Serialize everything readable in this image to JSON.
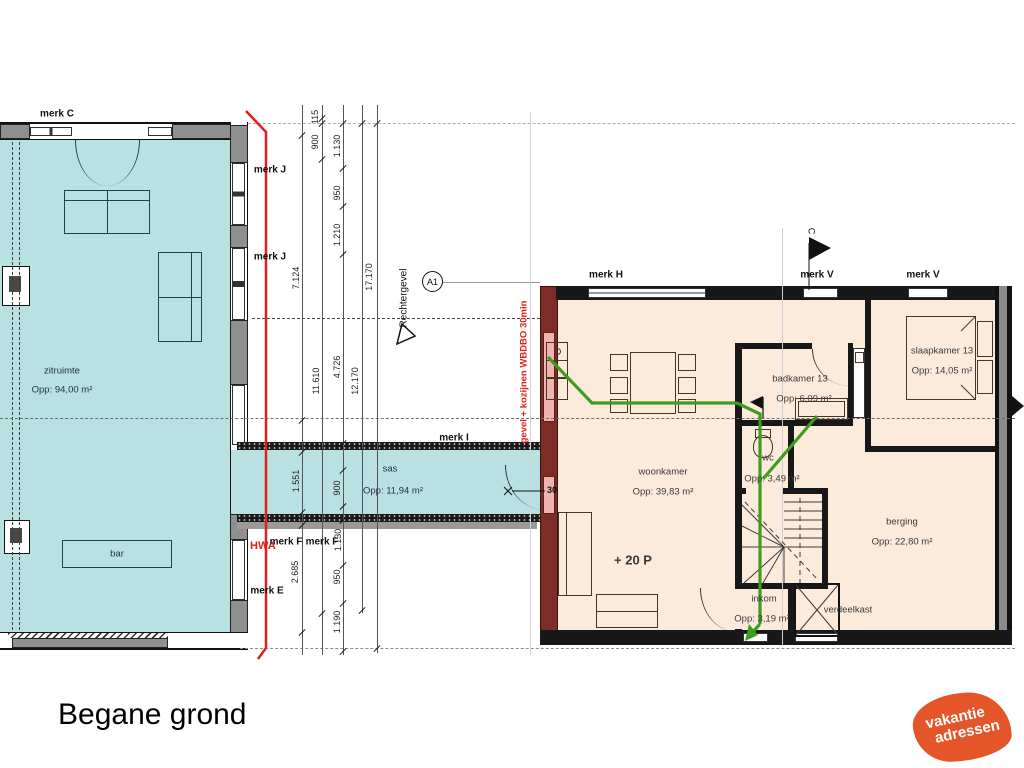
{
  "title": "Begane grond",
  "logo": {
    "line1": "vakantie",
    "line2": "adressen",
    "color": "#e4562a"
  },
  "rooms": {
    "zitruimte": {
      "name": "zitruimte",
      "area": "Opp: 94,00 m²"
    },
    "bar": {
      "name": "bar"
    },
    "sas": {
      "name": "sas",
      "area": "Opp: 11,94 m²"
    },
    "woonkamer": {
      "name": "woonkamer",
      "area": "Opp: 39,83 m²",
      "capacity": "+ 20 P"
    },
    "badkamer": {
      "name": "badkamer 13",
      "area": "Opp: 6,09 m²"
    },
    "wc": {
      "name": "wc",
      "area": "Opp: 3,49 m²"
    },
    "slaapkamer": {
      "name": "slaapkamer 13",
      "area": "Opp: 14,05 m²"
    },
    "berging": {
      "name": "berging",
      "area": "Opp: 22,80 m²"
    },
    "inkom": {
      "name": "inkom",
      "area": "Opp: 3,19 m²"
    },
    "verdeelkast": {
      "name": "verdeelkast"
    }
  },
  "annotations": {
    "rechtergevel": "Rechtergevel",
    "section_marker": "A1",
    "hwa": "HWA",
    "fire_wall_note": "gevel + kozijnen WBDBO 30min",
    "door_rating": "30",
    "flag_label": "C"
  },
  "merk_labels": [
    {
      "text": "merk C",
      "x": 57,
      "y": 114
    },
    {
      "text": "merk J",
      "x": 270,
      "y": 170
    },
    {
      "text": "merk J",
      "x": 270,
      "y": 257
    },
    {
      "text": "merk I",
      "x": 454,
      "y": 438
    },
    {
      "text": "merk F",
      "x": 286,
      "y": 542
    },
    {
      "text": "merk F",
      "x": 322,
      "y": 542
    },
    {
      "text": "merk E",
      "x": 267,
      "y": 591
    },
    {
      "text": "merk H",
      "x": 606,
      "y": 275
    },
    {
      "text": "merk V",
      "x": 817,
      "y": 275
    },
    {
      "text": "merk V",
      "x": 923,
      "y": 275
    }
  ],
  "dimensions": [
    {
      "text": "7.124",
      "x": 296,
      "y": 278
    },
    {
      "text": "1.551",
      "x": 296,
      "y": 481
    },
    {
      "text": "2.685",
      "x": 295,
      "y": 572
    },
    {
      "text": "115",
      "x": 315,
      "y": 117
    },
    {
      "text": "900",
      "x": 315,
      "y": 142
    },
    {
      "text": "11.610",
      "x": 316,
      "y": 381
    },
    {
      "text": "1.130",
      "x": 337,
      "y": 146
    },
    {
      "text": "950",
      "x": 337,
      "y": 193
    },
    {
      "text": "1.210",
      "x": 337,
      "y": 235
    },
    {
      "text": "4.726",
      "x": 337,
      "y": 367
    },
    {
      "text": "900",
      "x": 337,
      "y": 488
    },
    {
      "text": "1.130",
      "x": 338,
      "y": 540
    },
    {
      "text": "950",
      "x": 337,
      "y": 577
    },
    {
      "text": "1.190",
      "x": 337,
      "y": 622
    },
    {
      "text": "12.170",
      "x": 355,
      "y": 381
    },
    {
      "text": "17.170",
      "x": 369,
      "y": 277
    }
  ],
  "colors": {
    "floor_left": "#b9e1e2",
    "floor_right": "#fceadb",
    "fire_wall": "#7b2d26",
    "window_fire": "#f2b3ac",
    "escape_route": "#3f9c1e",
    "fire_line": "#e31e1e",
    "logo_orange": "#e4562a"
  }
}
